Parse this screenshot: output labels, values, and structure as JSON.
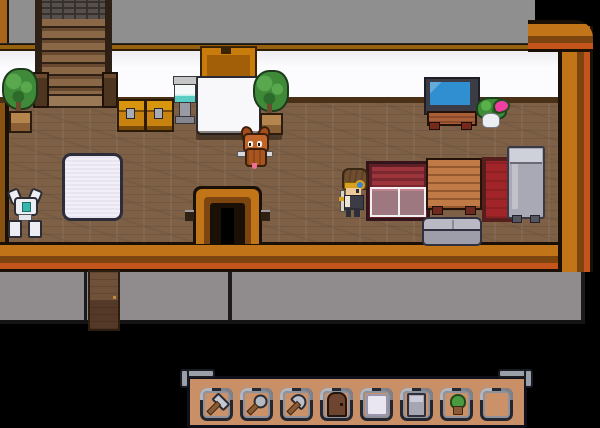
{
  "meta": {
    "title": "Top-down pixel-art RPG house interior",
    "canvas": {
      "width": 600,
      "height": 414
    },
    "visible_text": []
  },
  "palette": {
    "background": "#000000",
    "roof_gray": "#8f8f8f",
    "wall_white": "#fcfcfe",
    "floor_wood": "#7d6046",
    "wall_border_orange": "#c27418",
    "wall_border_dark": "#7c440e",
    "wall_border_red": "#c2541c",
    "foundation_gray": "#908c8e",
    "hotbar_tan": "#c98f66",
    "slot_frame": "#26262e",
    "tv_screen_blue": "#2f8fd0",
    "bed_red": "#9c343c",
    "dresser_orange": "#c07a45",
    "creature_fox_orange": "#c1662a",
    "monster_pink": "#ef3fa0",
    "cooler_teal": "#59ccc4"
  },
  "scene": {
    "rooms": [
      {
        "name": "stairwell",
        "features": [
          "staircase-up",
          "brick-landing",
          "newel-posts"
        ]
      },
      {
        "name": "hall-left",
        "features": [
          "potted-plant",
          "storage-chests",
          "water-cooler",
          "white-mat",
          "orange-door",
          "white-alcove"
        ]
      },
      {
        "name": "bedroom-right",
        "features": [
          "tv-on-stand",
          "red-bed-with-sheet",
          "dresser",
          "red-rug",
          "gray-bed",
          "sofa"
        ]
      }
    ],
    "entities": [
      {
        "name": "player-character",
        "kind": "player",
        "appearance": "brown hair, yellow goggles with blue lens, dark outfit, holding staff"
      },
      {
        "name": "fox-creature",
        "kind": "pet",
        "appearance": "orange horned fox-like critter with tongue out"
      },
      {
        "name": "skeleton-robot-creature",
        "kind": "pet",
        "appearance": "white bone critter with teal core"
      },
      {
        "name": "plant-monster-creature",
        "kind": "pet",
        "appearance": "leafy green creature with pink mouth"
      }
    ],
    "exits": [
      {
        "name": "staircase-up",
        "position": "top-left"
      },
      {
        "name": "orange-interior-door",
        "position": "top-center"
      },
      {
        "name": "wooden-exterior-door",
        "position": "bottom-left foundation"
      }
    ]
  },
  "hud": {
    "hotbar": {
      "slot_count": 8,
      "slots": [
        {
          "item": "hammer",
          "icon": "hammer-icon",
          "rotated": true
        },
        {
          "item": "magnifying-glass",
          "icon": "magnifier-icon",
          "rotated": true
        },
        {
          "item": "axe",
          "icon": "axe-icon",
          "rotated": true
        },
        {
          "item": "wooden-door",
          "icon": "door-icon",
          "rotated": false
        },
        {
          "item": "mat",
          "icon": "mat-icon",
          "rotated": false
        },
        {
          "item": "bed",
          "icon": "bed-icon",
          "rotated": false
        },
        {
          "item": "potted-plant",
          "icon": "plant-icon",
          "rotated": false
        },
        {
          "item": "",
          "icon": "empty",
          "rotated": false
        }
      ]
    }
  }
}
